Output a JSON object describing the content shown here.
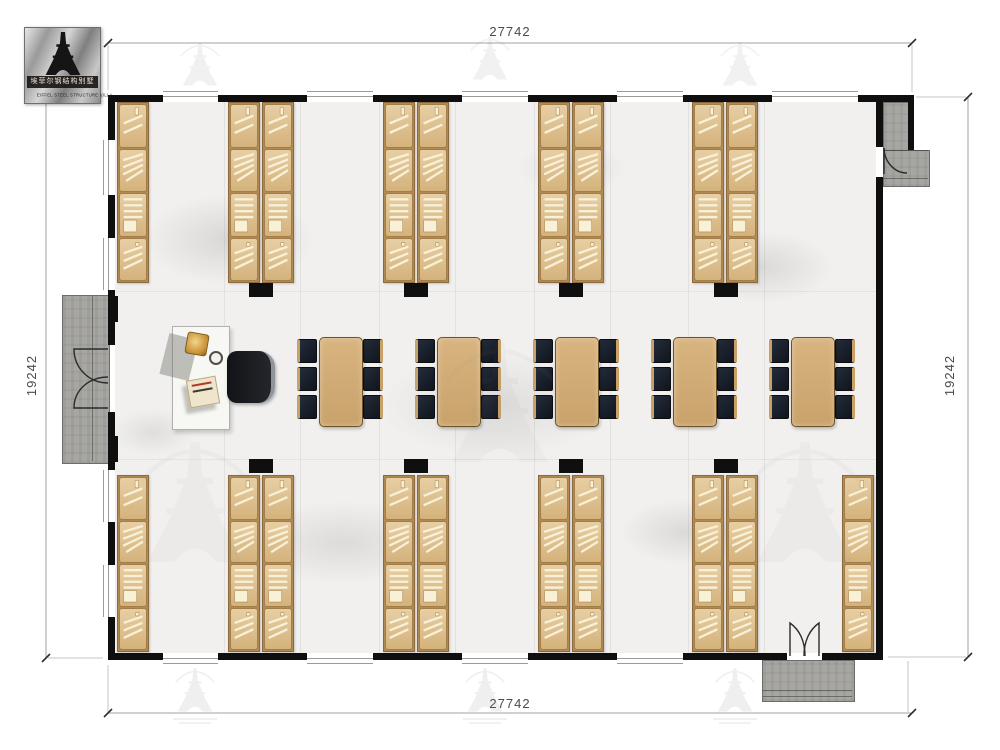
{
  "logo": {
    "icon": "eiffel-tower-icon",
    "name_cn": "埃菲尔钢结构别墅",
    "name_en": "EIFFEL STEEL STRUCTURE VILLA"
  },
  "dimensions": {
    "top": "27742",
    "bottom": "27742",
    "left": "19242",
    "right": "19242"
  },
  "summary": {
    "bed_columns_top_row": 9,
    "bed_columns_bottom_row": 10,
    "segments_per_bed_column": 4,
    "dining_tables": 5,
    "chairs_per_table": 6,
    "office_desks": 1,
    "entrances": 3
  },
  "colors": {
    "wall": "#0f0f0f",
    "bed_wood": "#d8b788",
    "bed_slat": "#f8f0d7",
    "table_wood": "#cfa874",
    "chair_dark": "#1b2330",
    "chair_trim": "#c9a066",
    "porch_concrete": "#a7a6a2",
    "floor_marble": "#f1f0ee",
    "dimension_text": "#4a4a4a"
  },
  "floorplan": {
    "structure": {
      "walls": [
        {
          "x": 108,
          "y": 95,
          "w": 55,
          "h": 7
        },
        {
          "x": 218,
          "y": 95,
          "w": 89,
          "h": 7
        },
        {
          "x": 373,
          "y": 95,
          "w": 89,
          "h": 7
        },
        {
          "x": 528,
          "y": 95,
          "w": 89,
          "h": 7
        },
        {
          "x": 683,
          "y": 95,
          "w": 89,
          "h": 7
        },
        {
          "x": 858,
          "y": 95,
          "w": 56,
          "h": 7
        },
        {
          "x": 108,
          "y": 653,
          "w": 55,
          "h": 7
        },
        {
          "x": 218,
          "y": 653,
          "w": 89,
          "h": 7
        },
        {
          "x": 373,
          "y": 653,
          "w": 89,
          "h": 7
        },
        {
          "x": 528,
          "y": 653,
          "w": 89,
          "h": 7
        },
        {
          "x": 683,
          "y": 653,
          "w": 104,
          "h": 7
        },
        {
          "x": 822,
          "y": 653,
          "w": 61,
          "h": 7
        },
        {
          "x": 108,
          "y": 95,
          "w": 7,
          "h": 45
        },
        {
          "x": 108,
          "y": 195,
          "w": 7,
          "h": 43
        },
        {
          "x": 108,
          "y": 290,
          "w": 7,
          "h": 55
        },
        {
          "x": 108,
          "y": 412,
          "w": 7,
          "h": 58
        },
        {
          "x": 108,
          "y": 522,
          "w": 7,
          "h": 43
        },
        {
          "x": 108,
          "y": 617,
          "w": 7,
          "h": 43
        },
        {
          "x": 876,
          "y": 95,
          "w": 7,
          "h": 52
        },
        {
          "x": 876,
          "y": 177,
          "w": 7,
          "h": 483
        },
        {
          "x": 908,
          "y": 95,
          "w": 6,
          "h": 55
        }
      ],
      "windows_h": [
        {
          "x": 163,
          "y": 91,
          "w": 55
        },
        {
          "x": 307,
          "y": 91,
          "w": 66
        },
        {
          "x": 462,
          "y": 91,
          "w": 66
        },
        {
          "x": 617,
          "y": 91,
          "w": 66
        },
        {
          "x": 772,
          "y": 91,
          "w": 86
        },
        {
          "x": 163,
          "y": 658,
          "w": 55
        },
        {
          "x": 307,
          "y": 658,
          "w": 66
        },
        {
          "x": 462,
          "y": 658,
          "w": 66
        },
        {
          "x": 617,
          "y": 658,
          "w": 66
        }
      ],
      "windows_v": [
        {
          "x": 103,
          "y": 140,
          "h": 55
        },
        {
          "x": 103,
          "y": 238,
          "h": 52
        },
        {
          "x": 103,
          "y": 470,
          "h": 52
        },
        {
          "x": 103,
          "y": 565,
          "h": 52
        }
      ],
      "porches": [
        {
          "id": "west-entry-porch",
          "x": 62,
          "y": 295,
          "w": 46,
          "h": 167
        },
        {
          "id": "south-entry-porch",
          "x": 762,
          "y": 660,
          "w": 91,
          "h": 40
        },
        {
          "id": "northeast-entry-porch",
          "x": 883,
          "y": 102,
          "w": 25,
          "h": 48
        },
        {
          "id": "northeast-entry-steps",
          "x": 883,
          "y": 150,
          "w": 45,
          "h": 35
        }
      ],
      "stubs": [
        {
          "x": 249,
          "y": 283,
          "w": 24,
          "h": 14
        },
        {
          "x": 404,
          "y": 283,
          "w": 24,
          "h": 14
        },
        {
          "x": 559,
          "y": 283,
          "w": 24,
          "h": 14
        },
        {
          "x": 714,
          "y": 283,
          "w": 24,
          "h": 14
        },
        {
          "x": 249,
          "y": 459,
          "w": 24,
          "h": 14
        },
        {
          "x": 404,
          "y": 459,
          "w": 24,
          "h": 14
        },
        {
          "x": 559,
          "y": 459,
          "w": 24,
          "h": 14
        },
        {
          "x": 714,
          "y": 459,
          "w": 24,
          "h": 14
        },
        {
          "x": 108,
          "y": 296,
          "w": 10,
          "h": 26
        },
        {
          "x": 108,
          "y": 436,
          "w": 10,
          "h": 26
        }
      ],
      "plines": [
        {
          "x": 92,
          "y": 296,
          "w": 1,
          "h": 165
        },
        {
          "x": 763,
          "y": 690,
          "w": 89,
          "h": 1
        },
        {
          "x": 763,
          "y": 696,
          "w": 89,
          "h": 1
        },
        {
          "x": 883,
          "y": 150,
          "w": 45,
          "h": 1
        },
        {
          "x": 883,
          "y": 178,
          "w": 45,
          "h": 1
        }
      ]
    },
    "beds": {
      "col_w": 32,
      "segment_order": [
        "z",
        "fan",
        "pillow",
        "diag"
      ],
      "rows": [
        {
          "y": 102,
          "h": 181,
          "cols": [
            117,
            228,
            262,
            383,
            417,
            538,
            572,
            692,
            726
          ]
        },
        {
          "y": 475,
          "h": 177,
          "cols": [
            117,
            228,
            262,
            383,
            417,
            538,
            572,
            692,
            726,
            842
          ]
        }
      ]
    },
    "tables": {
      "centers_x": [
        340,
        458,
        576,
        694,
        812
      ],
      "y": 337,
      "w": 42,
      "h": 88,
      "chair_rows_y": [
        339,
        367,
        395
      ],
      "chair_w": 20,
      "chair_h": 24
    },
    "joints": {
      "vertical_x": [
        224,
        300,
        379,
        455,
        534,
        610,
        688,
        764
      ],
      "horizontal_y": [
        291,
        459
      ]
    }
  }
}
